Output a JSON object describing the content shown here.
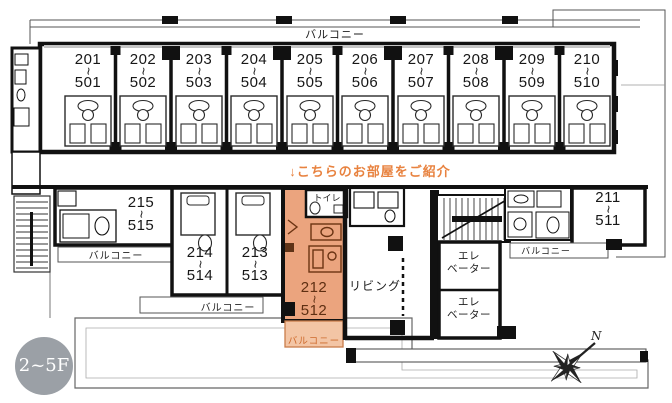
{
  "note": {
    "text": "↓こちらのお部屋をご紹介"
  },
  "labels": {
    "balcony": "バルコニー",
    "toilet": "トイレ",
    "living": "リビング",
    "elevator_line1": "エレ",
    "elevator_line2": "ベーター",
    "tilde": "~",
    "floor_badge": "2~5F",
    "compass_north": "N"
  },
  "rooms": {
    "top": [
      {
        "upper": "201",
        "lower": "501"
      },
      {
        "upper": "202",
        "lower": "502"
      },
      {
        "upper": "203",
        "lower": "503"
      },
      {
        "upper": "204",
        "lower": "504"
      },
      {
        "upper": "205",
        "lower": "505"
      },
      {
        "upper": "206",
        "lower": "506"
      },
      {
        "upper": "207",
        "lower": "507"
      },
      {
        "upper": "208",
        "lower": "508"
      },
      {
        "upper": "209",
        "lower": "509"
      },
      {
        "upper": "210",
        "lower": "510"
      }
    ],
    "bottom": [
      {
        "upper": "215",
        "lower": "515"
      },
      {
        "upper": "214",
        "lower": "514"
      },
      {
        "upper": "213",
        "lower": "513"
      },
      {
        "upper": "212",
        "lower": "512"
      },
      {
        "upper": "211",
        "lower": "511"
      }
    ]
  },
  "highlight": {
    "room": "212~512"
  },
  "colors": {
    "highlight_room": "#EBA47E",
    "highlight_balcony": "#F3C5A5",
    "accent_text": "#E8823F",
    "badge_bg": "#9BA0A6",
    "line": "#1a1a1a"
  }
}
